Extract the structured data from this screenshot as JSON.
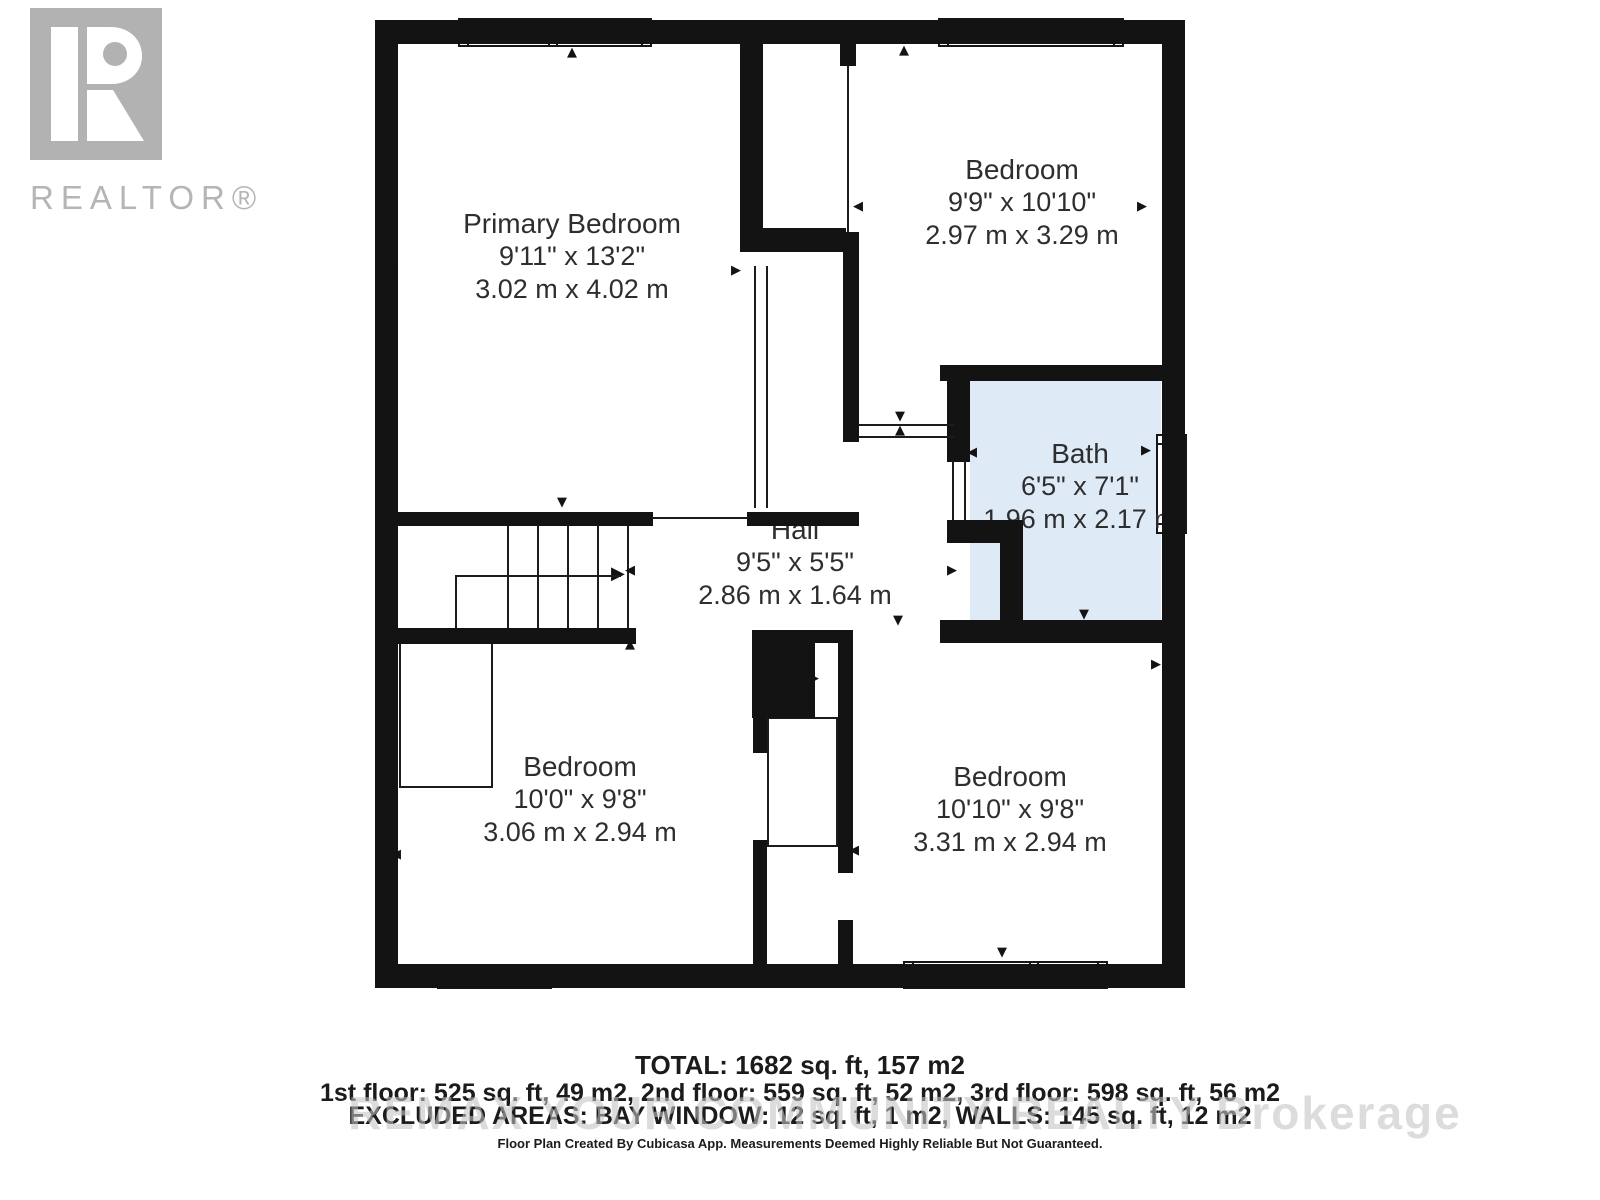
{
  "logo": {
    "label": "REALTOR®",
    "color": "#b2b2b2"
  },
  "rooms": [
    {
      "name": "Primary Bedroom",
      "imperial": "9'11\" x 13'2\"",
      "metric": "3.02 m x 4.02 m"
    },
    {
      "name": "Bedroom",
      "imperial": "9'9\" x 10'10\"",
      "metric": "2.97 m x 3.29 m"
    },
    {
      "name": "Bath",
      "imperial": "6'5\" x 7'1\"",
      "metric": "1.96 m x 2.17 m"
    },
    {
      "name": "Hall",
      "imperial": "9'5\" x 5'5\"",
      "metric": "2.86 m x 1.64 m"
    },
    {
      "name": "Bedroom",
      "imperial": "10'0\" x 9'8\"",
      "metric": "3.06 m x 2.94 m"
    },
    {
      "name": "Bedroom",
      "imperial": "10'10\" x 9'8\"",
      "metric": "3.31 m x 2.94 m"
    }
  ],
  "footer": {
    "total": "TOTAL: 1682 sq. ft, 157 m2",
    "floors": "1st floor: 525 sq. ft, 49 m2, 2nd floor: 559 sq. ft, 52 m2, 3rd floor: 598 sq. ft, 56 m2",
    "excluded": "EXCLUDED AREAS: BAY WINDOW: 12 sq. ft, 1 m2, WALLS: 145 sq. ft, 12 m2",
    "watermark": "REMAX YOUR COMMUNITY REALTY Brokerage",
    "disclaimer": "Floor Plan Created By Cubicasa App. Measurements Deemed Highly Reliable But Not Guaranteed."
  },
  "colors": {
    "wall": "#131313",
    "bath_fill": "#dfeaf7",
    "logo_gray": "#b2b2b2",
    "watermark_gray": "#c3c3c3",
    "text": "#2e2e2e"
  },
  "icons": {
    "arrow_up": "▲",
    "arrow_down": "▼",
    "arrow_left": "◀",
    "arrow_right": "▶",
    "stair_direction_arrow": "▶"
  }
}
